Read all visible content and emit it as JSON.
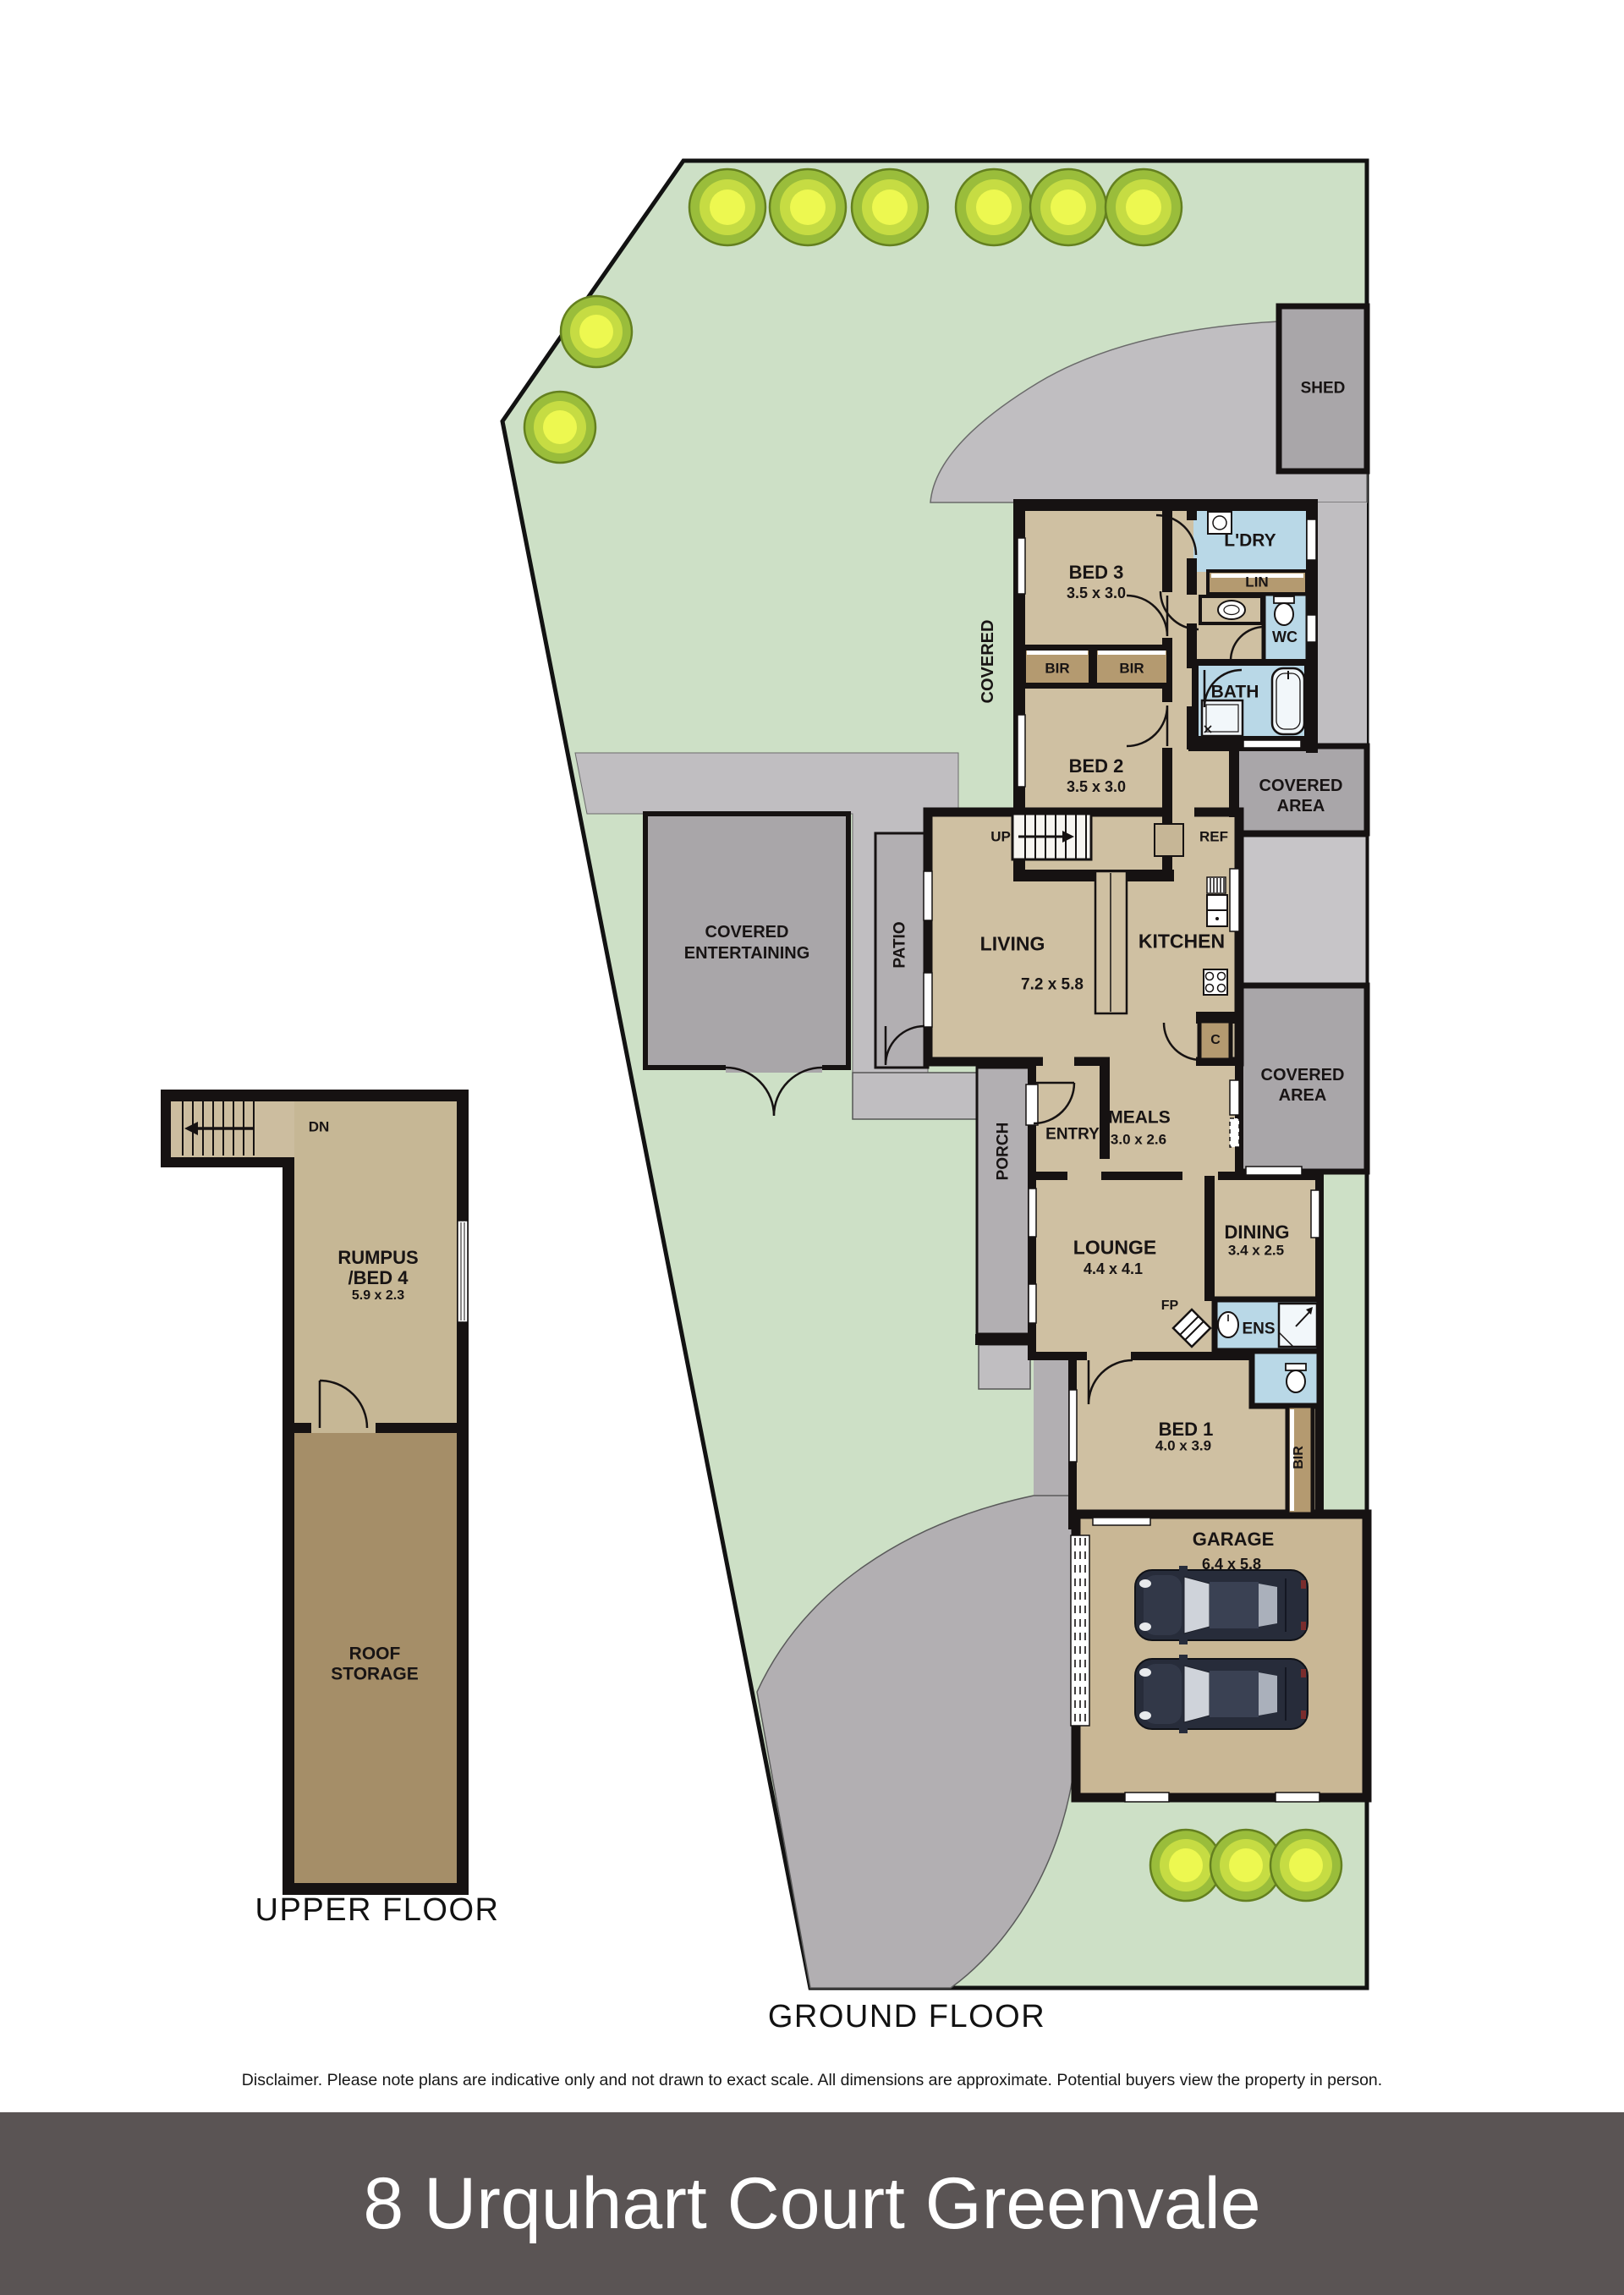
{
  "title_bar": {
    "text": "8 Urquhart Court Greenvale",
    "bg": "#5a5454",
    "fg": "#ffffff"
  },
  "disclaimer": "Disclaimer. Please note plans are indicative only and not drawn to exact scale. All dimensions are approximate. Potential buyers view the property in person.",
  "floors": {
    "ground": {
      "caption": "GROUND FLOOR"
    },
    "upper": {
      "caption": "UPPER FLOOR"
    }
  },
  "rooms": {
    "bed3": {
      "name": "BED 3",
      "dims": "3.5 x 3.0"
    },
    "bed2": {
      "name": "BED 2",
      "dims": "3.5 x 3.0"
    },
    "bed1": {
      "name": "BED 1",
      "dims": "4.0 x 3.9"
    },
    "living": {
      "name": "LIVING",
      "dims": "7.2 x 5.8"
    },
    "kitchen": {
      "name": "KITCHEN"
    },
    "meals": {
      "name": "MEALS",
      "dims": "3.0 x 2.6"
    },
    "lounge": {
      "name": "LOUNGE",
      "dims": "4.4 x 4.1"
    },
    "dining": {
      "name": "DINING",
      "dims": "3.4 x 2.5"
    },
    "garage": {
      "name": "GARAGE",
      "dims": "6.4 x 5.8"
    },
    "rumpus": {
      "line1": "RUMPUS",
      "line2": "/BED 4",
      "dims": "5.9 x 2.3"
    },
    "roof_storage": {
      "line1": "ROOF",
      "line2": "STORAGE"
    },
    "laundry": {
      "name": "L'DRY"
    },
    "linen": {
      "name": "LIN"
    },
    "wc": {
      "name": "WC"
    },
    "bath": {
      "name": "BATH"
    },
    "ens": {
      "name": "ENS"
    },
    "entry": {
      "name": "ENTRY"
    },
    "porch": {
      "name": "PORCH"
    },
    "patio": {
      "name": "PATIO"
    },
    "shed": {
      "name": "SHED"
    },
    "covered_walkway": {
      "name": "COVERED"
    },
    "covered_area": {
      "line1": "COVERED",
      "line2": "AREA"
    },
    "covered_entertaining": {
      "line1": "COVERED",
      "line2": "ENTERTAINING"
    },
    "robe": {
      "name": "BIR"
    },
    "cupboard": {
      "name": "C"
    },
    "fireplace": {
      "name": "FP"
    },
    "fridge": {
      "name": "REF"
    },
    "stairs": {
      "up": "UP",
      "down": "DN"
    }
  },
  "colors": {
    "lawn": "#cde0c6",
    "concrete": "#c0bec1",
    "paving": "#b2afb2",
    "covered": "#a9a6a9",
    "floor_tan": "#cfc0a2",
    "robe_tan": "#b49a70",
    "wet_blue": "#b9d8e7",
    "storage_brown": "#a58e68",
    "garage_tan": "#c9b795",
    "wall": "#161212",
    "bush": "#cde144",
    "car": "#272c3a",
    "footer_bg": "#5a5454"
  }
}
